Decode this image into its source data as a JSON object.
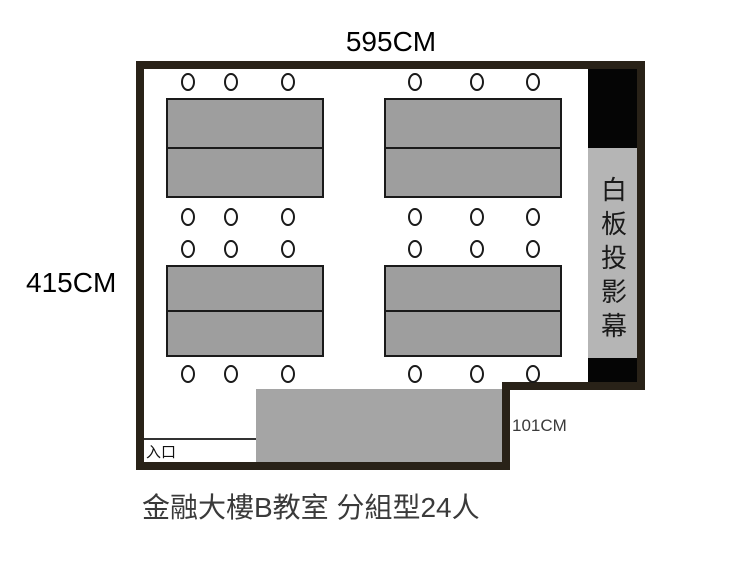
{
  "room": {
    "width_label": "595CM",
    "height_label": "415CM",
    "step_depth_label": "101CM",
    "entrance_label": "入口",
    "screen_label": "白板投影幕"
  },
  "caption": "金融大樓B教室 分組型24人",
  "furniture": {
    "group_tables": 4,
    "chairs_per_table": 6,
    "total_chairs": 24,
    "has_front_desk": true
  },
  "colors": {
    "wall": "#292218",
    "table_fill": "#9e9e9e",
    "desk_fill": "#a5a5a5",
    "screen_fill": "#b5b5b5",
    "screen_black_panel": "#050505",
    "background": "#ffffff",
    "dimension_text": "#000000",
    "caption_text": "#3a3a3a"
  }
}
